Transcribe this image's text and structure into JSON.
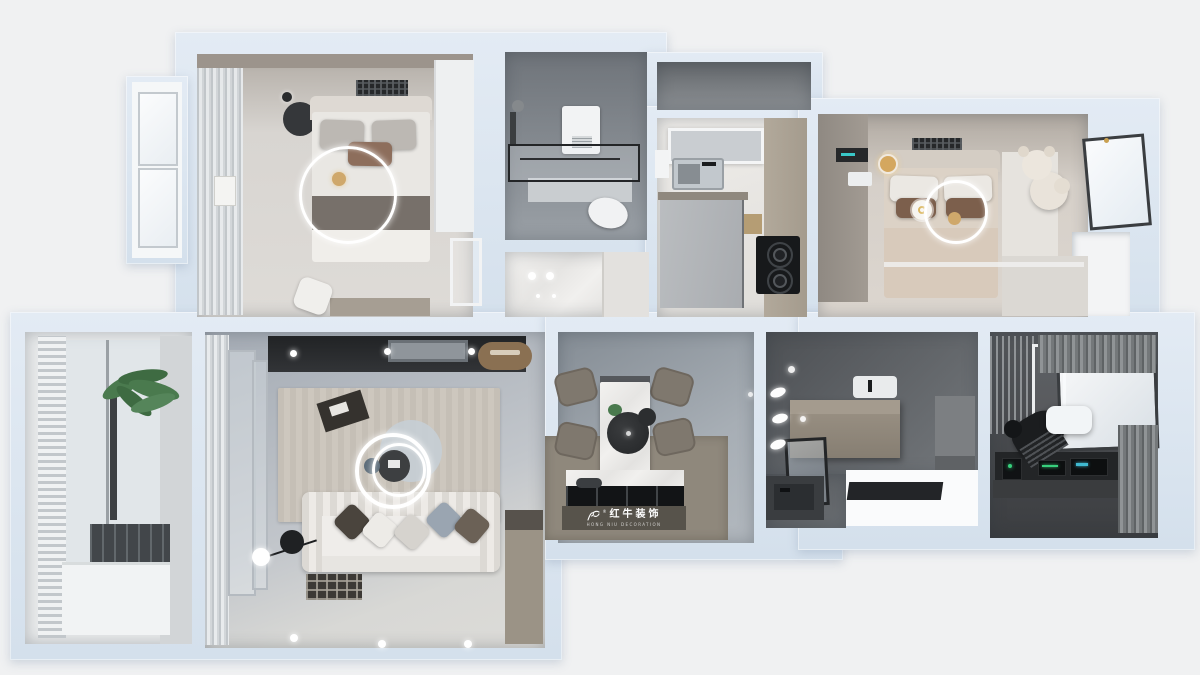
{
  "watermark": {
    "brand_cn": "红牛装饰",
    "brand_en": "HONG NIU DECORATION",
    "registered": "®"
  },
  "palette": {
    "background": "#f0f1f2",
    "wall": "#dbe5ef",
    "floor_concrete_living": "#aeb5bd",
    "floor_concrete_dining": "#99a1a8",
    "floor_greige_bedroom": "#cbc5bf",
    "floor_marble_kitchen": "#eae8e5",
    "floor_dark_bath": "#5a5d60",
    "floor_dark_study": "#4c4e50",
    "island_taupe": "#8f887c",
    "logo_band": "#57534b",
    "accent_wood": "#8a7052",
    "accent_brown_pillow": "#8d6e5c",
    "accent_gold": "#cfa86b",
    "plant_green": "#4a7a4e",
    "ring_light": "#ffffff"
  },
  "rooms": [
    {
      "id": "bedroom-primary",
      "furniture": [
        "double-bed",
        "curtains",
        "bay-window",
        "wardrobe",
        "floor-mirror",
        "desk",
        "stool",
        "nightstand",
        "ceiling-ring-light",
        "ceiling-grille"
      ]
    },
    {
      "id": "bathroom-main",
      "furniture": [
        "shower-glass",
        "toilet",
        "vanity",
        "water-heater",
        "shower-set"
      ]
    },
    {
      "id": "entry-hall",
      "furniture": [
        "cabinet",
        "downlights",
        "marble-floor"
      ]
    },
    {
      "id": "kitchen",
      "furniture": [
        "sink",
        "light-panel",
        "entry-door",
        "gas-stove",
        "counter",
        "water-heater"
      ]
    },
    {
      "id": "bedroom-second",
      "furniture": [
        "double-bed",
        "teddy-bear",
        "wardrobe",
        "clock-unit",
        "wall-sconce",
        "ring-light",
        "side-cabinet",
        "window",
        "niche"
      ]
    },
    {
      "id": "living-room",
      "furniture": [
        "tv-console",
        "tv",
        "sofa",
        "pillows",
        "rug",
        "coffee-table",
        "ring-chandelier",
        "floor-lamp",
        "sliding-doors",
        "curtains",
        "mat"
      ]
    },
    {
      "id": "balcony",
      "furniture": [
        "louver-blinds",
        "glass-wall",
        "palm-plant",
        "dark-mat",
        "bench"
      ]
    },
    {
      "id": "dining-room",
      "furniture": [
        "marble-table",
        "chairs-x4",
        "pendant-lamp",
        "island-counter",
        "cooktop",
        "logo-band"
      ]
    },
    {
      "id": "bathroom-second",
      "furniture": [
        "wall-spotlights",
        "storage-box",
        "washbasin",
        "mirror-window",
        "vanity-sink",
        "shelf"
      ]
    },
    {
      "id": "study",
      "furniture": [
        "slat-screen",
        "white-frame",
        "curtains",
        "window",
        "ac-unit",
        "gaming-chair",
        "keyboard",
        "desk",
        "monitors",
        "pc-tower"
      ]
    }
  ]
}
